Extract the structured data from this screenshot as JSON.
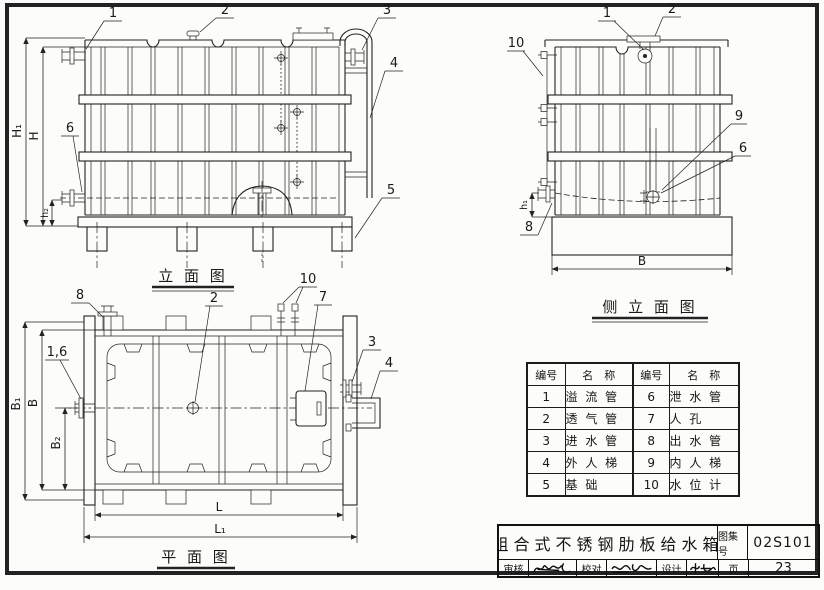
{
  "colors": {
    "ink": "#222222",
    "paper": "#fcfcfa"
  },
  "elevation": {
    "title": "立 面 图",
    "c1": "1",
    "c2": "2",
    "c3": "3",
    "c4": "4",
    "c5": "5",
    "c6": "6",
    "dim_h1": "H₁",
    "dim_h": "H",
    "dim_h2": "h₂"
  },
  "side": {
    "title": "侧 立 面 图",
    "c1": "1",
    "c2": "2",
    "c6": "6",
    "c8": "8",
    "c9": "9",
    "c10": "10",
    "dim_b": "B",
    "dim_hs": "h₁"
  },
  "plan": {
    "title": "平 面 图",
    "c2": "2",
    "c3": "3",
    "c4": "4",
    "c7": "7",
    "c8": "8",
    "c10": "10",
    "c16": "1,6",
    "dim_b1": "B₁",
    "dim_b": "B",
    "dim_b2": "B₂",
    "dim_l": "L",
    "dim_l1": "L₁"
  },
  "parts_table": {
    "col_no_a": "编号",
    "col_name_a": "名　称",
    "col_no_b": "编号",
    "col_name_b": "名　称",
    "rows": [
      {
        "no_a": "1",
        "name_a": "溢 流 管",
        "no_b": "6",
        "name_b": "泄 水 管"
      },
      {
        "no_a": "2",
        "name_a": "透 气 管",
        "no_b": "7",
        "name_b": "人 孔"
      },
      {
        "no_a": "3",
        "name_a": "进 水 管",
        "no_b": "8",
        "name_b": "出 水 管"
      },
      {
        "no_a": "4",
        "name_a": "外 人 梯",
        "no_b": "9",
        "name_b": "内 人 梯"
      },
      {
        "no_a": "5",
        "name_a": "基 础",
        "no_b": "10",
        "name_b": "水 位 计"
      }
    ]
  },
  "title_block": {
    "drawing_title": "组合式不锈钢肋板给水箱",
    "atlas_label": "图集号",
    "atlas_no": "02S101",
    "page_label": "页",
    "page_no": "23",
    "reviewer_label": "审核",
    "checker_label": "校对",
    "designer_label": "设计"
  }
}
